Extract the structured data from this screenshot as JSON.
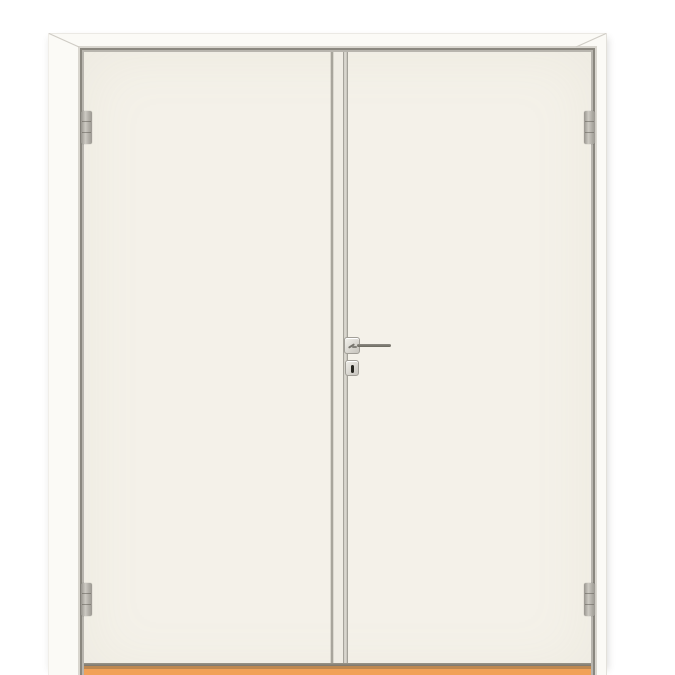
{
  "scene": {
    "subject": "white double interior swing door with frame, four hinges, lever handle, keyhole and orange wooden threshold",
    "background_color": "#ffffff"
  },
  "colors": {
    "background": "#ffffff",
    "frame_white": "#fbfaf6",
    "door_leaf": "#f4f1e9",
    "reveal_light": "#d9d6cf",
    "reveal_dark": "#8a877f",
    "reveal_mid": "#b8b5ae",
    "hinge_metal": "#b7b4ad",
    "handle_metal": "#8e8b84",
    "keyhole": "#26251f",
    "threshold_orange": "#f1a158",
    "threshold_edge": "#bd8851",
    "door_bottom_shadow": "#7c766c",
    "miter_line": "#cfccc5"
  },
  "parts": {
    "frame": "door-frame",
    "left_leaf": "left-door-leaf",
    "right_leaf": "right-door-leaf",
    "meeting_stile_gap": "gap-between-leaves",
    "hinges": [
      "top-left-hinge",
      "bottom-left-hinge",
      "top-right-hinge",
      "bottom-right-hinge"
    ],
    "handle": "lever-handle-on-square-rosette",
    "escutcheon": "square-escutcheon-with-keyhole",
    "threshold": "wooden-threshold-sill"
  }
}
